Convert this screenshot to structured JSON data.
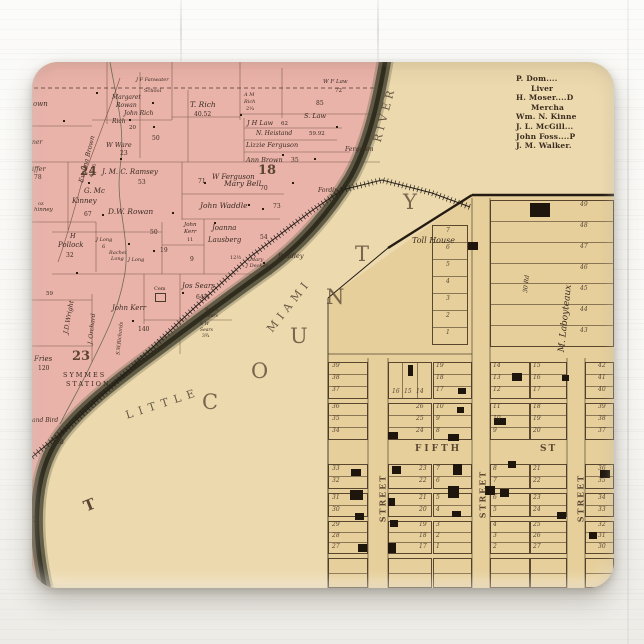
{
  "directory": {
    "lines": [
      {
        "t": "P. Dom....",
        "ind": false
      },
      {
        "t": "Liver",
        "ind": true
      },
      {
        "t": "H. Moser....D",
        "ind": false
      },
      {
        "t": "Mercha",
        "ind": true
      },
      {
        "t": "Wm. N. Kinne",
        "ind": false
      },
      {
        "t": "J. L. McGill...",
        "ind": false
      },
      {
        "t": "John Foss....P",
        "ind": false
      },
      {
        "t": "J. M. Walker.",
        "ind": false
      }
    ]
  },
  "colors": {
    "paper": "#ecd9ae",
    "township_pink": "#eab3aa",
    "plat_yellow": "#e6cf9b",
    "river": "#55523d",
    "ink": "#3a2b20"
  },
  "county_letters": [
    {
      "t": "C",
      "x": 170,
      "y": 330
    },
    {
      "t": "O",
      "x": 219,
      "y": 299
    },
    {
      "t": "U",
      "x": 258,
      "y": 264
    },
    {
      "t": "N",
      "x": 294,
      "y": 225
    },
    {
      "t": "T",
      "x": 323,
      "y": 182
    },
    {
      "t": "Y",
      "x": 371,
      "y": 130
    }
  ],
  "river_words": [
    {
      "t": "LITTLE",
      "x": 92,
      "y": 336,
      "r": -18,
      "s": 11,
      "ls": 6
    },
    {
      "t": "MIAMI",
      "x": 225,
      "y": 238,
      "r": -52,
      "s": 11,
      "ls": 5
    },
    {
      "t": "RIVER",
      "x": 324,
      "y": 47,
      "r": -75,
      "s": 11,
      "ls": 4
    }
  ],
  "pink_labels": [
    {
      "t": "own",
      "x": 1,
      "y": 39,
      "s": 7,
      "i": 1
    },
    {
      "t": "Evelina Brown",
      "x": 31,
      "y": 94,
      "s": 6.5,
      "i": 1,
      "r": -76
    },
    {
      "t": "43 ½",
      "x": 55,
      "y": 106,
      "s": 5.5,
      "r": -76
    },
    {
      "t": "Margaret",
      "x": 80,
      "y": 33,
      "s": 6,
      "i": 1
    },
    {
      "t": "Rowan",
      "x": 84,
      "y": 41,
      "s": 6,
      "i": 1
    },
    {
      "t": "John Rich",
      "x": 92,
      "y": 49,
      "s": 6,
      "i": 1
    },
    {
      "t": "Rich",
      "x": 80,
      "y": 57,
      "s": 6,
      "i": 1
    },
    {
      "t": "20",
      "x": 97,
      "y": 64,
      "s": 5.5
    },
    {
      "t": "School",
      "x": 112,
      "y": 27,
      "s": 5
    },
    {
      "t": "J F Fanwater",
      "x": 104,
      "y": 16,
      "s": 5,
      "i": 1
    },
    {
      "t": "T. Rich",
      "x": 158,
      "y": 39,
      "s": 7.5,
      "i": 1
    },
    {
      "t": "40.52",
      "x": 162,
      "y": 50,
      "s": 6
    },
    {
      "t": "A M",
      "x": 212,
      "y": 31,
      "s": 5,
      "i": 1
    },
    {
      "t": "Rich",
      "x": 212,
      "y": 38,
      "s": 5,
      "i": 1
    },
    {
      "t": "2¼",
      "x": 214,
      "y": 45,
      "s": 5
    },
    {
      "t": "J H Law",
      "x": 215,
      "y": 58,
      "s": 6.5,
      "i": 1
    },
    {
      "t": "62",
      "x": 249,
      "y": 60,
      "s": 5.5
    },
    {
      "t": "W F Law",
      "x": 291,
      "y": 18,
      "s": 5.5,
      "i": 1
    },
    {
      "t": "72",
      "x": 303,
      "y": 27,
      "s": 5.5
    },
    {
      "t": "85",
      "x": 284,
      "y": 39,
      "s": 6
    },
    {
      "t": "S. Law",
      "x": 272,
      "y": 51,
      "s": 6.5,
      "i": 1
    },
    {
      "t": "N. Heistand",
      "x": 224,
      "y": 69,
      "s": 6,
      "i": 1
    },
    {
      "t": "59.92",
      "x": 277,
      "y": 70,
      "s": 5.5
    },
    {
      "t": "Lizzie Ferguson",
      "x": 214,
      "y": 80,
      "s": 6.5,
      "i": 1
    },
    {
      "t": "Ferguson",
      "x": 313,
      "y": 85,
      "s": 6,
      "i": 1
    },
    {
      "t": "Ann Brown",
      "x": 214,
      "y": 95,
      "s": 6.5,
      "i": 1
    },
    {
      "t": "35",
      "x": 259,
      "y": 96,
      "s": 6
    },
    {
      "t": "18",
      "x": 226,
      "y": 102,
      "s": 13,
      "b": 1
    },
    {
      "t": "W Ferguson",
      "x": 180,
      "y": 112,
      "s": 7,
      "i": 1
    },
    {
      "t": "70",
      "x": 228,
      "y": 124,
      "s": 6
    },
    {
      "t": "71",
      "x": 166,
      "y": 117,
      "s": 6
    },
    {
      "t": "Mary Bell",
      "x": 192,
      "y": 118,
      "s": 7.5,
      "i": 1
    },
    {
      "t": "John Waddle",
      "x": 168,
      "y": 140,
      "s": 7.5,
      "i": 1
    },
    {
      "t": "73",
      "x": 241,
      "y": 142,
      "s": 6
    },
    {
      "t": "50",
      "x": 120,
      "y": 74,
      "s": 6
    },
    {
      "t": "W Ware",
      "x": 74,
      "y": 80,
      "s": 6.5,
      "i": 1
    },
    {
      "t": "23",
      "x": 88,
      "y": 89,
      "s": 6
    },
    {
      "t": "J. M. C. Ramsey",
      "x": 70,
      "y": 107,
      "s": 7,
      "i": 1
    },
    {
      "t": "53",
      "x": 106,
      "y": 118,
      "s": 6
    },
    {
      "t": "24",
      "x": 48,
      "y": 103,
      "s": 12,
      "b": 1
    },
    {
      "t": "G. Mc",
      "x": 52,
      "y": 126,
      "s": 7,
      "i": 1
    },
    {
      "t": "Kinney",
      "x": 40,
      "y": 136,
      "s": 7,
      "i": 1
    },
    {
      "t": "67",
      "x": 52,
      "y": 150,
      "s": 6
    },
    {
      "t": "iffer",
      "x": 0,
      "y": 104,
      "s": 6.5,
      "i": 1
    },
    {
      "t": "78",
      "x": 2,
      "y": 113,
      "s": 6
    },
    {
      "t": "ner",
      "x": 0,
      "y": 78,
      "s": 6,
      "i": 1
    },
    {
      "t": "oz",
      "x": 6,
      "y": 140,
      "s": 5
    },
    {
      "t": "hinney",
      "x": 2,
      "y": 146,
      "s": 5.5,
      "i": 1
    },
    {
      "t": "D.W. Rowan",
      "x": 76,
      "y": 146,
      "s": 7.5,
      "i": 1
    },
    {
      "t": "50",
      "x": 118,
      "y": 168,
      "s": 6
    },
    {
      "t": "H",
      "x": 38,
      "y": 171,
      "s": 6.5,
      "i": 1
    },
    {
      "t": "Pollock",
      "x": 26,
      "y": 180,
      "s": 7,
      "i": 1
    },
    {
      "t": "32",
      "x": 34,
      "y": 191,
      "s": 6
    },
    {
      "t": "J Long",
      "x": 64,
      "y": 176,
      "s": 5,
      "i": 1
    },
    {
      "t": "6",
      "x": 70,
      "y": 183,
      "s": 5
    },
    {
      "t": "Rachel",
      "x": 77,
      "y": 189,
      "s": 5,
      "i": 1
    },
    {
      "t": "Long",
      "x": 79,
      "y": 195,
      "s": 5,
      "i": 1
    },
    {
      "t": "J Long",
      "x": 96,
      "y": 196,
      "s": 5,
      "i": 1
    },
    {
      "t": "19",
      "x": 128,
      "y": 186,
      "s": 6
    },
    {
      "t": "John",
      "x": 152,
      "y": 161,
      "s": 5.5,
      "i": 1
    },
    {
      "t": "Kerr",
      "x": 152,
      "y": 168,
      "s": 5.5,
      "i": 1
    },
    {
      "t": "11",
      "x": 155,
      "y": 176,
      "s": 5
    },
    {
      "t": "Joanna",
      "x": 180,
      "y": 163,
      "s": 7,
      "i": 1
    },
    {
      "t": "Lausberg",
      "x": 176,
      "y": 175,
      "s": 7,
      "i": 1
    },
    {
      "t": "54",
      "x": 228,
      "y": 173,
      "s": 6
    },
    {
      "t": "9",
      "x": 158,
      "y": 195,
      "s": 6
    },
    {
      "t": "12½",
      "x": 198,
      "y": 194,
      "s": 5
    },
    {
      "t": "Mary",
      "x": 218,
      "y": 196,
      "s": 5,
      "i": 1
    },
    {
      "t": "J Decker",
      "x": 214,
      "y": 202,
      "s": 5,
      "i": 1
    },
    {
      "t": "Bradley",
      "x": 246,
      "y": 191,
      "s": 6.5,
      "i": 1
    },
    {
      "t": "Fording",
      "x": 286,
      "y": 126,
      "s": 6,
      "i": 1
    },
    {
      "t": "J.D.Wright",
      "x": 20,
      "y": 252,
      "s": 6.5,
      "i": 1,
      "r": -80
    },
    {
      "t": "59",
      "x": 14,
      "y": 230,
      "s": 5.5
    },
    {
      "t": "John Kerr",
      "x": 80,
      "y": 243,
      "s": 7,
      "i": 1
    },
    {
      "t": "140",
      "x": 106,
      "y": 265,
      "s": 6
    },
    {
      "t": "Cem",
      "x": 122,
      "y": 225,
      "s": 5
    },
    {
      "t": "Jos Sears",
      "x": 150,
      "y": 221,
      "s": 7,
      "i": 1
    },
    {
      "t": "64¾",
      "x": 164,
      "y": 233,
      "s": 6
    },
    {
      "t": "W 1¼",
      "x": 173,
      "y": 247,
      "s": 4.5,
      "i": 1
    },
    {
      "t": "Sears",
      "x": 173,
      "y": 253,
      "s": 4.5,
      "i": 1
    },
    {
      "t": "S W",
      "x": 168,
      "y": 261,
      "s": 4.5,
      "i": 1
    },
    {
      "t": "Sears",
      "x": 168,
      "y": 267,
      "s": 4.5,
      "i": 1
    },
    {
      "t": "3¾",
      "x": 170,
      "y": 273,
      "s": 4.5
    },
    {
      "t": "S.W.Richards",
      "x": 72,
      "y": 274,
      "s": 5,
      "i": 1,
      "r": -84
    },
    {
      "t": "J. Orchard",
      "x": 45,
      "y": 264,
      "s": 6,
      "i": 1,
      "r": -84
    },
    {
      "t": "23",
      "x": 40,
      "y": 288,
      "s": 13,
      "b": 1
    },
    {
      "t": "Fries",
      "x": 2,
      "y": 294,
      "s": 7,
      "i": 1
    },
    {
      "t": "120",
      "x": 6,
      "y": 304,
      "s": 6
    },
    {
      "t": "SYMMES",
      "x": 31,
      "y": 310,
      "s": 6.5,
      "c": 1
    },
    {
      "t": "STATION",
      "x": 34,
      "y": 319,
      "s": 6.5,
      "c": 1
    },
    {
      "t": "and Bird",
      "x": 0,
      "y": 356,
      "s": 6,
      "i": 1
    },
    {
      "t": "58",
      "x": 24,
      "y": 378,
      "s": 6
    },
    {
      "t": "2",
      "x": 1,
      "y": 455,
      "s": 7
    },
    {
      "t": "T",
      "x": 52,
      "y": 436,
      "s": 15,
      "b": 1,
      "r": -22
    }
  ],
  "plat_labels": [
    {
      "t": "Toll House",
      "x": 380,
      "y": 175,
      "s": 8,
      "i": 1
    },
    {
      "t": "M. Laboyteaux",
      "x": 500,
      "y": 252,
      "s": 9,
      "i": 1,
      "r": -84
    },
    {
      "t": "30 Rd",
      "x": 486,
      "y": 219,
      "s": 6,
      "i": 1,
      "r": -84
    },
    {
      "t": "FIFTH",
      "x": 383,
      "y": 383,
      "s": 9,
      "b": 1,
      "ls": 3
    },
    {
      "t": "ST",
      "x": 508,
      "y": 383,
      "s": 9,
      "b": 1,
      "ls": 2
    },
    {
      "t": "STREET",
      "x": 326,
      "y": 432,
      "s": 8,
      "b": 1,
      "ls": 2,
      "r": -90
    },
    {
      "t": "STREET",
      "x": 426,
      "y": 428,
      "s": 8,
      "b": 1,
      "ls": 2,
      "r": -90
    },
    {
      "t": "STREET",
      "x": 524,
      "y": 432,
      "s": 8,
      "b": 1,
      "ls": 2,
      "r": -90
    }
  ],
  "lot_numbers": [
    {
      "t": "49",
      "x": 548,
      "y": 140
    },
    {
      "t": "48",
      "x": 548,
      "y": 161
    },
    {
      "t": "47",
      "x": 548,
      "y": 182
    },
    {
      "t": "46",
      "x": 548,
      "y": 203
    },
    {
      "t": "45",
      "x": 548,
      "y": 224
    },
    {
      "t": "44",
      "x": 548,
      "y": 245
    },
    {
      "t": "43",
      "x": 548,
      "y": 266
    },
    {
      "t": "7",
      "x": 414,
      "y": 166
    },
    {
      "t": "6",
      "x": 414,
      "y": 183
    },
    {
      "t": "5",
      "x": 414,
      "y": 200
    },
    {
      "t": "4",
      "x": 414,
      "y": 217
    },
    {
      "t": "3",
      "x": 414,
      "y": 234
    },
    {
      "t": "2",
      "x": 414,
      "y": 251
    },
    {
      "t": "1",
      "x": 414,
      "y": 268
    },
    {
      "t": "39",
      "x": 300,
      "y": 301
    },
    {
      "t": "38",
      "x": 300,
      "y": 313
    },
    {
      "t": "37",
      "x": 300,
      "y": 325
    },
    {
      "t": "36",
      "x": 300,
      "y": 342
    },
    {
      "t": "35",
      "x": 300,
      "y": 354
    },
    {
      "t": "34",
      "x": 300,
      "y": 366
    },
    {
      "t": "33",
      "x": 300,
      "y": 404
    },
    {
      "t": "32",
      "x": 300,
      "y": 416
    },
    {
      "t": "31",
      "x": 300,
      "y": 433
    },
    {
      "t": "30",
      "x": 300,
      "y": 445
    },
    {
      "t": "29",
      "x": 300,
      "y": 460
    },
    {
      "t": "28",
      "x": 300,
      "y": 471
    },
    {
      "t": "27",
      "x": 300,
      "y": 482
    },
    {
      "t": "16",
      "x": 360,
      "y": 327
    },
    {
      "t": "15",
      "x": 372,
      "y": 327
    },
    {
      "t": "14",
      "x": 384,
      "y": 327
    },
    {
      "t": "26",
      "x": 384,
      "y": 342
    },
    {
      "t": "25",
      "x": 384,
      "y": 354
    },
    {
      "t": "24",
      "x": 384,
      "y": 366
    },
    {
      "t": "23",
      "x": 387,
      "y": 404
    },
    {
      "t": "22",
      "x": 387,
      "y": 416
    },
    {
      "t": "21",
      "x": 387,
      "y": 433
    },
    {
      "t": "20",
      "x": 387,
      "y": 445
    },
    {
      "t": "19",
      "x": 387,
      "y": 460
    },
    {
      "t": "18",
      "x": 387,
      "y": 471
    },
    {
      "t": "17",
      "x": 387,
      "y": 482
    },
    {
      "t": "19",
      "x": 404,
      "y": 301
    },
    {
      "t": "18",
      "x": 404,
      "y": 313
    },
    {
      "t": "17",
      "x": 404,
      "y": 325
    },
    {
      "t": "10",
      "x": 404,
      "y": 342
    },
    {
      "t": "9",
      "x": 404,
      "y": 354
    },
    {
      "t": "8",
      "x": 404,
      "y": 366
    },
    {
      "t": "7",
      "x": 404,
      "y": 404
    },
    {
      "t": "6",
      "x": 404,
      "y": 416
    },
    {
      "t": "5",
      "x": 404,
      "y": 433
    },
    {
      "t": "4",
      "x": 404,
      "y": 445
    },
    {
      "t": "3",
      "x": 404,
      "y": 460
    },
    {
      "t": "2",
      "x": 404,
      "y": 471
    },
    {
      "t": "1",
      "x": 404,
      "y": 482
    },
    {
      "t": "14",
      "x": 461,
      "y": 301
    },
    {
      "t": "13",
      "x": 461,
      "y": 313
    },
    {
      "t": "12",
      "x": 461,
      "y": 325
    },
    {
      "t": "11",
      "x": 461,
      "y": 342
    },
    {
      "t": "10",
      "x": 461,
      "y": 354
    },
    {
      "t": "9",
      "x": 461,
      "y": 366
    },
    {
      "t": "8",
      "x": 461,
      "y": 404
    },
    {
      "t": "7",
      "x": 461,
      "y": 416
    },
    {
      "t": "6",
      "x": 461,
      "y": 433
    },
    {
      "t": "5",
      "x": 461,
      "y": 445
    },
    {
      "t": "4",
      "x": 461,
      "y": 460
    },
    {
      "t": "3",
      "x": 461,
      "y": 471
    },
    {
      "t": "2",
      "x": 461,
      "y": 482
    },
    {
      "t": "15",
      "x": 501,
      "y": 301
    },
    {
      "t": "16",
      "x": 501,
      "y": 313
    },
    {
      "t": "17",
      "x": 501,
      "y": 325
    },
    {
      "t": "18",
      "x": 501,
      "y": 342
    },
    {
      "t": "19",
      "x": 501,
      "y": 354
    },
    {
      "t": "20",
      "x": 501,
      "y": 366
    },
    {
      "t": "21",
      "x": 501,
      "y": 404
    },
    {
      "t": "22",
      "x": 501,
      "y": 416
    },
    {
      "t": "23",
      "x": 501,
      "y": 433
    },
    {
      "t": "24",
      "x": 501,
      "y": 445
    },
    {
      "t": "25",
      "x": 501,
      "y": 460
    },
    {
      "t": "26",
      "x": 501,
      "y": 471
    },
    {
      "t": "27",
      "x": 501,
      "y": 482
    },
    {
      "t": "42",
      "x": 566,
      "y": 301
    },
    {
      "t": "41",
      "x": 566,
      "y": 313
    },
    {
      "t": "40",
      "x": 566,
      "y": 325
    },
    {
      "t": "39",
      "x": 566,
      "y": 342
    },
    {
      "t": "38",
      "x": 566,
      "y": 354
    },
    {
      "t": "37",
      "x": 566,
      "y": 366
    },
    {
      "t": "36",
      "x": 566,
      "y": 404
    },
    {
      "t": "35",
      "x": 566,
      "y": 416
    },
    {
      "t": "34",
      "x": 566,
      "y": 433
    },
    {
      "t": "33",
      "x": 566,
      "y": 445
    },
    {
      "t": "32",
      "x": 566,
      "y": 460
    },
    {
      "t": "31",
      "x": 566,
      "y": 471
    },
    {
      "t": "30",
      "x": 566,
      "y": 482
    }
  ],
  "plat_geometry": {
    "special_blocks": [
      {
        "x": 400,
        "y": 163,
        "w": 36,
        "h": 120,
        "rows": 7
      },
      {
        "x": 458,
        "y": 138,
        "w": 124,
        "h": 147,
        "rows": 7
      }
    ],
    "columns": [
      {
        "x": 296,
        "w": 40
      },
      {
        "x": 356,
        "w": 44
      },
      {
        "x": 401,
        "w": 39
      },
      {
        "x": 458,
        "w": 40
      },
      {
        "x": 498,
        "w": 37
      },
      {
        "x": 553,
        "w": 29
      }
    ],
    "bands": [
      {
        "y": 300,
        "h": 37,
        "rows": 3
      },
      {
        "y": 341,
        "h": 37,
        "rows": 3
      },
      {
        "y": 402,
        "h": 25,
        "rows": 2
      },
      {
        "y": 431,
        "h": 24,
        "rows": 2
      },
      {
        "y": 459,
        "h": 33,
        "rows": 3
      },
      {
        "y": 496,
        "h": 30,
        "rows": 2
      }
    ]
  },
  "buildings": [
    [
      498,
      141,
      20,
      14
    ],
    [
      436,
      180,
      10,
      8
    ],
    [
      530,
      313,
      7,
      6
    ],
    [
      376,
      303,
      5,
      11
    ],
    [
      356,
      370,
      10,
      7
    ],
    [
      426,
      326,
      8,
      6
    ],
    [
      425,
      345,
      7,
      6
    ],
    [
      416,
      372,
      11,
      7
    ],
    [
      462,
      356,
      12,
      7
    ],
    [
      480,
      311,
      10,
      8
    ],
    [
      319,
      407,
      10,
      7
    ],
    [
      360,
      404,
      9,
      8
    ],
    [
      421,
      402,
      9,
      11
    ],
    [
      318,
      428,
      13,
      10
    ],
    [
      356,
      436,
      7,
      8
    ],
    [
      416,
      424,
      11,
      12
    ],
    [
      323,
      451,
      9,
      7
    ],
    [
      358,
      458,
      8,
      7
    ],
    [
      420,
      449,
      9,
      6
    ],
    [
      326,
      482,
      9,
      8
    ],
    [
      356,
      481,
      8,
      10
    ],
    [
      476,
      399,
      8,
      7
    ],
    [
      468,
      427,
      9,
      8
    ],
    [
      525,
      450,
      9,
      7
    ],
    [
      568,
      408,
      10,
      8
    ],
    [
      453,
      424,
      10,
      9
    ],
    [
      557,
      470,
      8,
      7
    ]
  ],
  "farm_dots": [
    [
      31,
      58
    ],
    [
      64,
      30
    ],
    [
      97,
      57
    ],
    [
      121,
      64
    ],
    [
      56,
      120
    ],
    [
      88,
      96
    ],
    [
      140,
      150
    ],
    [
      121,
      188
    ],
    [
      182,
      160
    ],
    [
      150,
      230
    ],
    [
      96,
      181
    ],
    [
      260,
      120
    ],
    [
      230,
      146
    ],
    [
      304,
      64
    ],
    [
      231,
      200
    ],
    [
      208,
      52
    ],
    [
      250,
      92
    ],
    [
      120,
      40
    ],
    [
      70,
      152
    ],
    [
      44,
      210
    ],
    [
      100,
      258
    ],
    [
      172,
      120
    ],
    [
      216,
      142
    ],
    [
      282,
      96
    ]
  ]
}
